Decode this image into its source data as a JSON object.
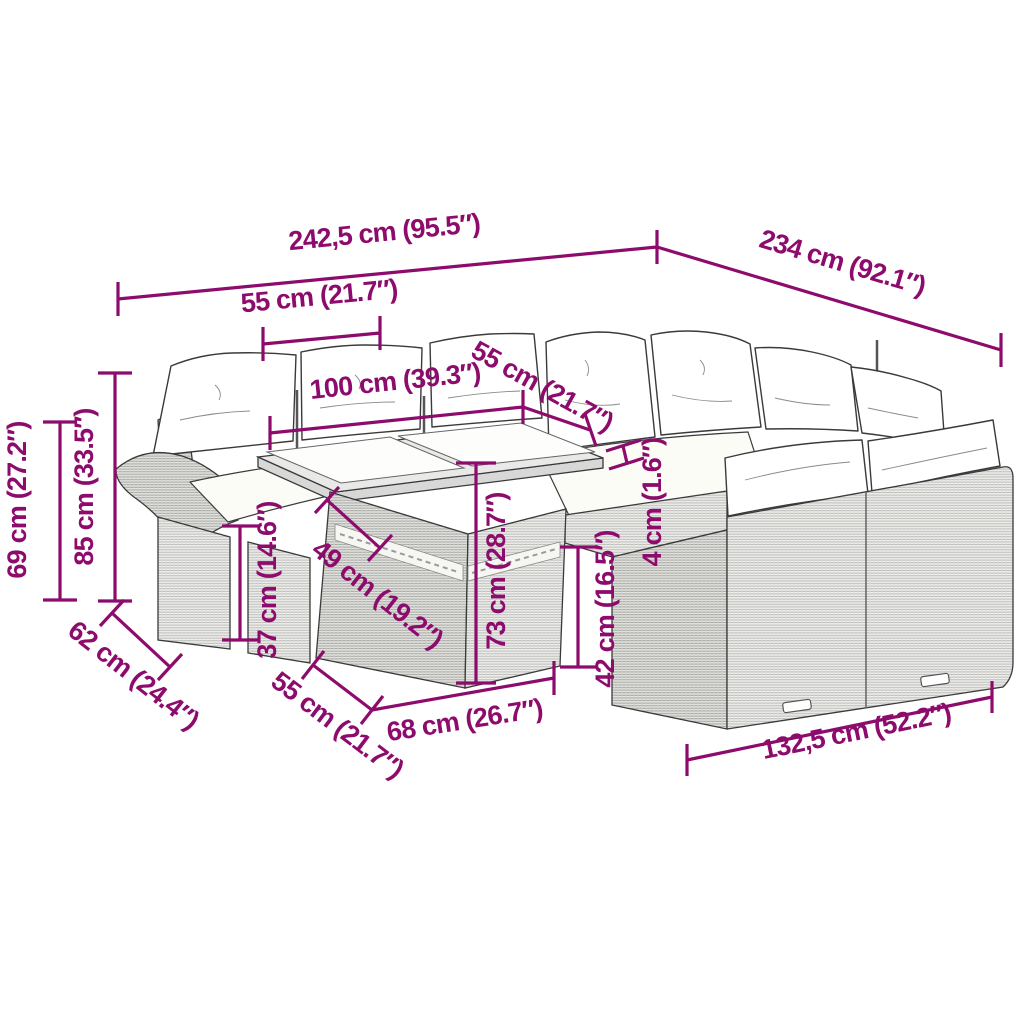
{
  "colors": {
    "accent": "#8D0B6C",
    "line_art": "#3a3a3a",
    "wicker_light": "#f1f1ef",
    "wicker_dark": "#e6e6e3",
    "cushion": "#ffffff"
  },
  "figure": {
    "kind": "furniture-dimension-diagram",
    "subject": "poly-rattan garden lounge set with glass-top table and cushions"
  },
  "dims": {
    "total_width": {
      "label": "242,5 cm (95.5″)"
    },
    "total_depth": {
      "label": "234 cm (92.1″)"
    },
    "seat_width_back": {
      "label": "55 cm (21.7″)"
    },
    "left_sofa_width": {
      "label": "100 cm (39.3″)"
    },
    "seat_width_side": {
      "label": "55 cm (21.7″)"
    },
    "armrest_height": {
      "label": "69 cm (27.2″)"
    },
    "back_height": {
      "label": "85 cm (33.5″)"
    },
    "armrest_depth": {
      "label": "62 cm (24.4″)"
    },
    "seat_to_arm": {
      "label": "37 cm (14.6″)"
    },
    "table_depth": {
      "label": "49 cm (19.2″)"
    },
    "table_height": {
      "label": "73 cm (28.7″)"
    },
    "glass_thickness": {
      "label": "4 cm (1.6″)"
    },
    "seat_height": {
      "label": "42 cm (16.5″)"
    },
    "seat_depth": {
      "label": "55 cm (21.7″)"
    },
    "table_width": {
      "label": "68 cm (26.7″)"
    },
    "right_sofa_width": {
      "label": "132,5 cm (52.2″)"
    }
  }
}
